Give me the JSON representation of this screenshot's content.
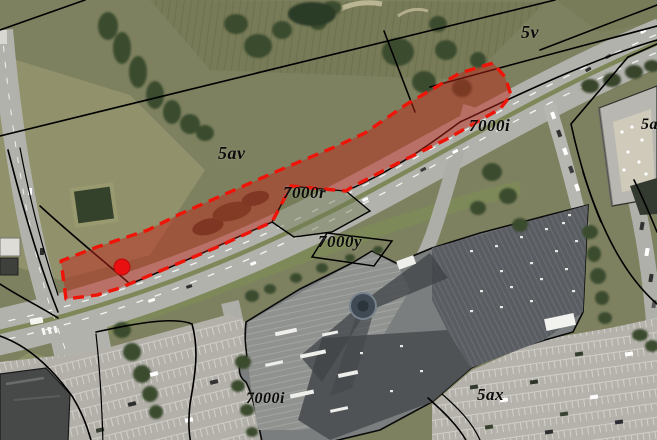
{
  "parcel_labels": [
    {
      "id": "5v",
      "text": "5v"
    },
    {
      "id": "5av",
      "text": "5av"
    },
    {
      "id": "7000i-upper",
      "text": "7000i"
    },
    {
      "id": "7000r",
      "text": "7000r"
    },
    {
      "id": "7000y",
      "text": "7000y"
    },
    {
      "id": "7000i-lower",
      "text": "7000i"
    },
    {
      "id": "5ax",
      "text": "5ax"
    },
    {
      "id": "5a-clipped",
      "text": "5a"
    }
  ],
  "highlight_area": {
    "border_color": "#ee1408",
    "border_style": "dashed",
    "fill_color": "#c0281a",
    "fill_opacity": "0.48"
  },
  "marker": {
    "shape": "circle",
    "color": "#e81010"
  }
}
